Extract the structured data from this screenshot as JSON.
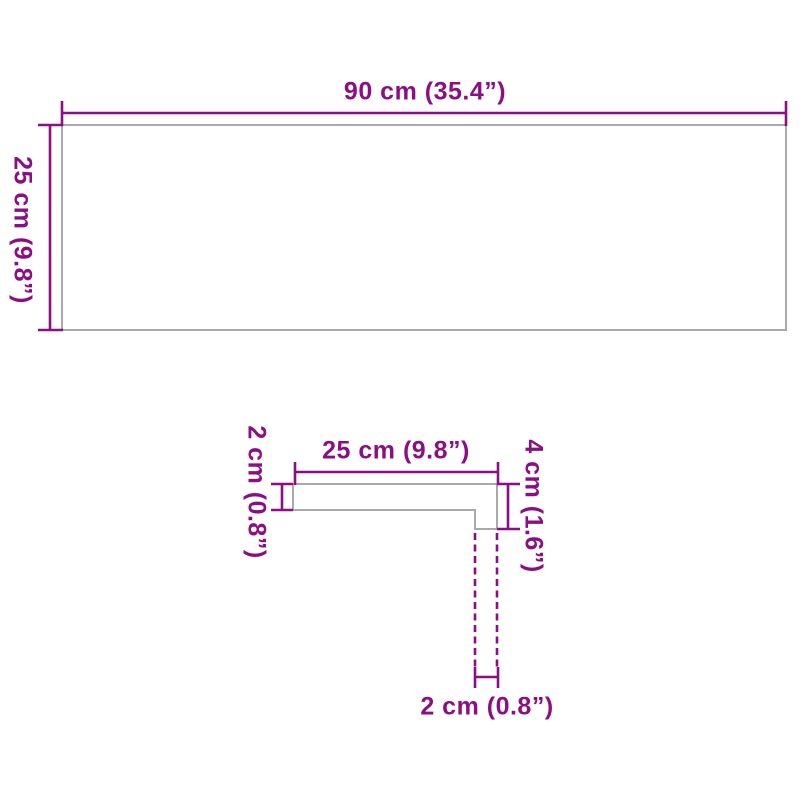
{
  "colors": {
    "dimension_magenta": "#8C0E85",
    "shape_outline_gray": "#A9A9A9",
    "background": "#FFFFFF"
  },
  "board": {
    "width_label": "90 cm (35.4”)",
    "height_label": "25 cm (9.8”)"
  },
  "profile": {
    "top_width_label": "25 cm (9.8”)",
    "left_thickness_label": "2 cm (0.8”)",
    "right_height_label": "4 cm (1.6”)",
    "bottom_thickness_label": "2 cm (0.8”)"
  }
}
